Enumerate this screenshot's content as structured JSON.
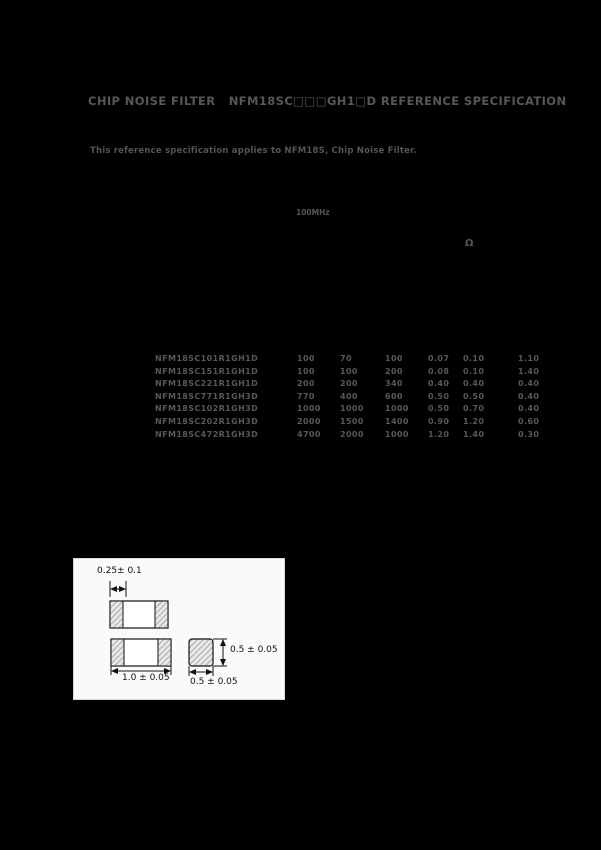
{
  "page": {
    "background": "#000000",
    "text_color": "#585858"
  },
  "header": {
    "title": "CHIP NOISE FILTER   NFM18SC□□□GH1□D REFERENCE SPECIFICATION"
  },
  "intro": {
    "text": "This reference specification applies to NFM18S, Chip Noise Filter."
  },
  "annotations": {
    "freq_label": "100MHz",
    "unit_symbol": "Ω"
  },
  "parts_table": {
    "rows": [
      {
        "part_number": "NFM18SC101R1GH1D",
        "values": [
          "100",
          "70",
          "100",
          "0.07",
          "0.10",
          "1.10"
        ]
      },
      {
        "part_number": "NFM18SC151R1GH1D",
        "values": [
          "100",
          "100",
          "200",
          "0.08",
          "0.10",
          "1.40"
        ]
      },
      {
        "part_number": "NFM18SC221R1GH1D",
        "values": [
          "200",
          "200",
          "340",
          "0.40",
          "0.40",
          "0.40"
        ]
      },
      {
        "part_number": "NFM18SC771R1GH3D",
        "values": [
          "770",
          "400",
          "600",
          "0.50",
          "0.50",
          "0.40"
        ]
      },
      {
        "part_number": "NFM18SC102R1GH3D",
        "values": [
          "1000",
          "1000",
          "1000",
          "0.50",
          "0.70",
          "0.40"
        ]
      },
      {
        "part_number": "NFM18SC202R1GH3D",
        "values": [
          "2000",
          "1500",
          "1400",
          "0.90",
          "1.20",
          "0.60"
        ]
      },
      {
        "part_number": "NFM18SC472R1GH3D",
        "values": [
          "4700",
          "2000",
          "1000",
          "1.20",
          "1.40",
          "0.30"
        ]
      }
    ]
  },
  "dimension_diagram": {
    "terminal_width": "0.25± 0.1",
    "length": "1.0 ± 0.05",
    "height": "0.5 ± 0.05",
    "width": "0.5 ± 0.05",
    "diagram_colors": {
      "paper": "#fafafa",
      "line": "#111111"
    }
  }
}
